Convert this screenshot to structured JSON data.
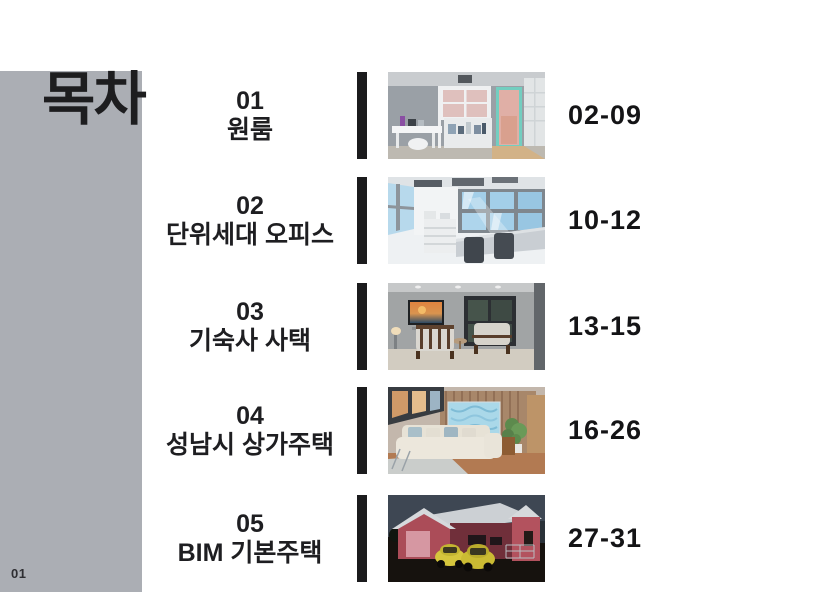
{
  "page": {
    "title": "목차",
    "page_number": "01"
  },
  "toc": {
    "entries": [
      {
        "number": "01",
        "title": "원룸",
        "pages": "02-09",
        "thumbnail_alt": "3D render of a studio apartment with gray walls, white desk, shelving and mint-green door frame"
      },
      {
        "number": "02",
        "title": "단위세대 오피스",
        "pages": "10-12",
        "thumbnail_alt": "3D render of a bright unit office with rows of sky-lit windows, white cabinets and two desk chairs"
      },
      {
        "number": "03",
        "title": "기숙사 사택",
        "pages": "13-15",
        "thumbnail_alt": "3D render of a dormitory lounge with wall TV showing a sunset, two wood-frame armchairs and a black framed window"
      },
      {
        "number": "04",
        "title": "성남시 상가주택",
        "pages": "16-26",
        "thumbnail_alt": "3D render of a living room with wood slat wall, blue artwork, cream sectional sofa and a plant"
      },
      {
        "number": "05",
        "title": "BIM 기본주택",
        "pages": "27-31",
        "thumbnail_alt": "3D render of a red gabled house at night with a white roof and two yellow cars parked in front"
      }
    ]
  },
  "colors": {
    "panel_gray": "#abaeb4",
    "divider_black": "#1b1b1d",
    "text_black": "#1e1e21"
  }
}
